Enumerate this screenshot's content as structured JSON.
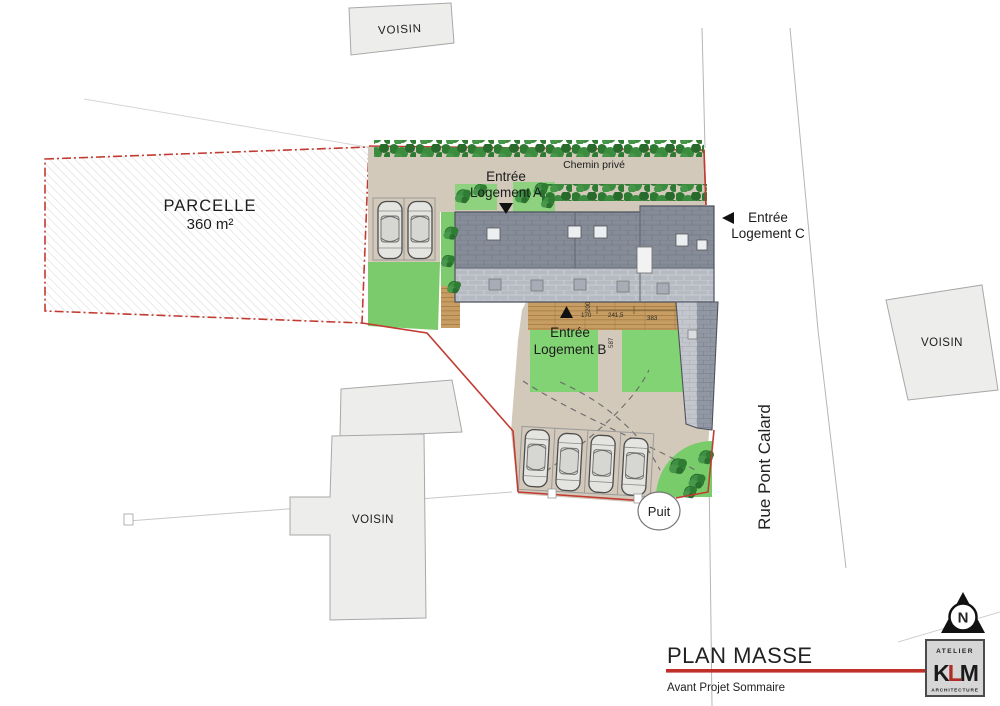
{
  "plan": {
    "parcel_label": "PARCELLE",
    "parcel_area": "360 m²",
    "private_path": "Chemin privé",
    "entrance_a": {
      "line1": "Entrée",
      "line2": "Logement A"
    },
    "entrance_b": {
      "line1": "Entrée",
      "line2": "Logement B"
    },
    "entrance_c": {
      "line1": "Entrée",
      "line2": "Logement C"
    },
    "street": "Rue Pont Calard",
    "well": "Puit",
    "neighbor_top": "VOISIN",
    "neighbor_right": "VOISIN",
    "neighbor_bottom": "VOISIN",
    "north_letter": "N",
    "dimensions": {
      "deck_left": "170",
      "deck_depth": "200",
      "deck_mid": "241,5",
      "deck_right": "383",
      "garden_depth": "587"
    }
  },
  "title_block": {
    "title": "PLAN MASSE",
    "subtitle": "Avant Projet Sommaire"
  },
  "logo": {
    "top": "ATELIER",
    "k": "K",
    "l": "L",
    "m": "M",
    "bottom": "ARCHITECTURE"
  },
  "colors": {
    "boundary_red": "#c23b32",
    "underline_red": "#c0302b",
    "site_tan": "#d2c9bb",
    "grass_green": "#7bcb6c",
    "garden_green": "#82d373",
    "hedge_green": "#2e7a32",
    "roof_dark": "#868c98",
    "roof_light": "#b6bac3",
    "neighbor_gray": "#ededec",
    "road_edge_gray": "#b5b5b5"
  }
}
